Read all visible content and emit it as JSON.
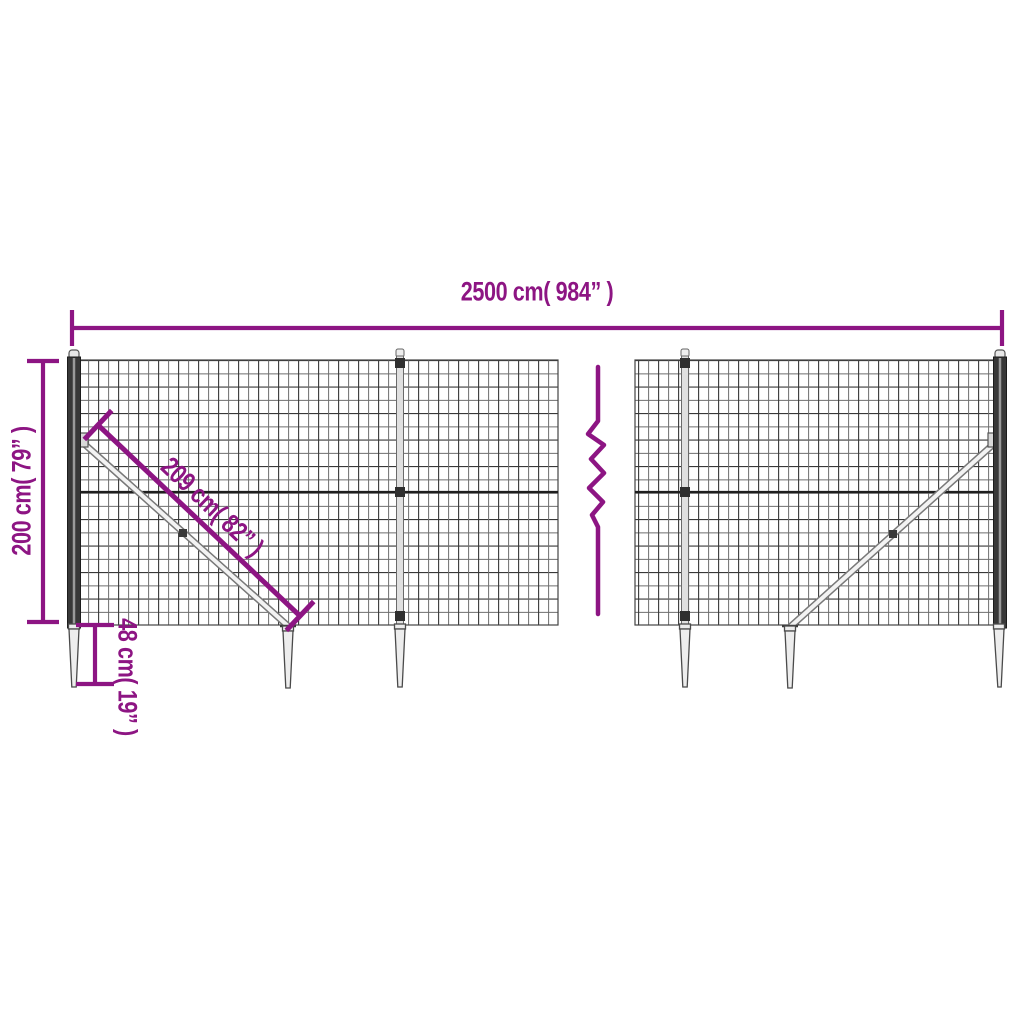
{
  "labels": {
    "width": "2500 cm( 984” )",
    "height": "200 cm( 79” )",
    "brace": "209 cm( 82” )",
    "spike_depth": "48 cm( 19” )"
  },
  "colors": {
    "dimension": "#8D1583",
    "mesh_wire": "#383838",
    "mesh_wire_light": "#6E6E6E",
    "post_dark": "#383838",
    "hardware_gray": "#787878",
    "spike_fill": "#EDEDED"
  }
}
